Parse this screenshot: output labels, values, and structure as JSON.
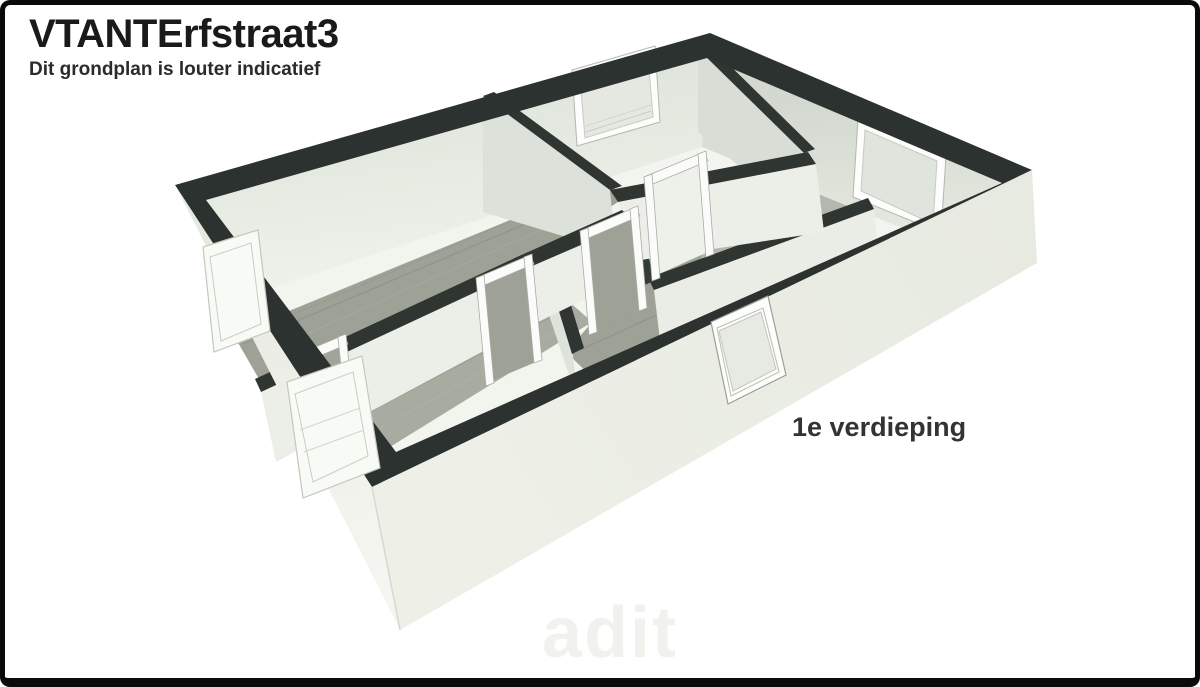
{
  "header": {
    "title": "VTANTErfstraat3",
    "subtitle": "Dit grondplan is louter indicatief"
  },
  "plan": {
    "floor_label": "1e verdieping",
    "watermark": "adit",
    "view": "3d-cutaway-floorplan",
    "colors": {
      "wall_top_band": "#2e3431",
      "interior_wall_light": "#e7ebe2",
      "interior_wall_shaded": "#d7ddd4",
      "exterior_wall": "#eef0e8",
      "floor_light": "#f2f4ee",
      "floor_wood_gray": "#9da196",
      "window_glass": "#e4e8e1",
      "window_frame": "#fdfdfc",
      "page_border": "#0a0a0a"
    },
    "features": {
      "windows": [
        "nw-interior-window",
        "ne-interior-window",
        "front-exterior-window",
        "left-exterior-window-upper",
        "left-exterior-window-lower"
      ],
      "doors": [
        "hall-door-1",
        "hall-door-2",
        "hall-door-3",
        "hall-door-4"
      ]
    }
  }
}
